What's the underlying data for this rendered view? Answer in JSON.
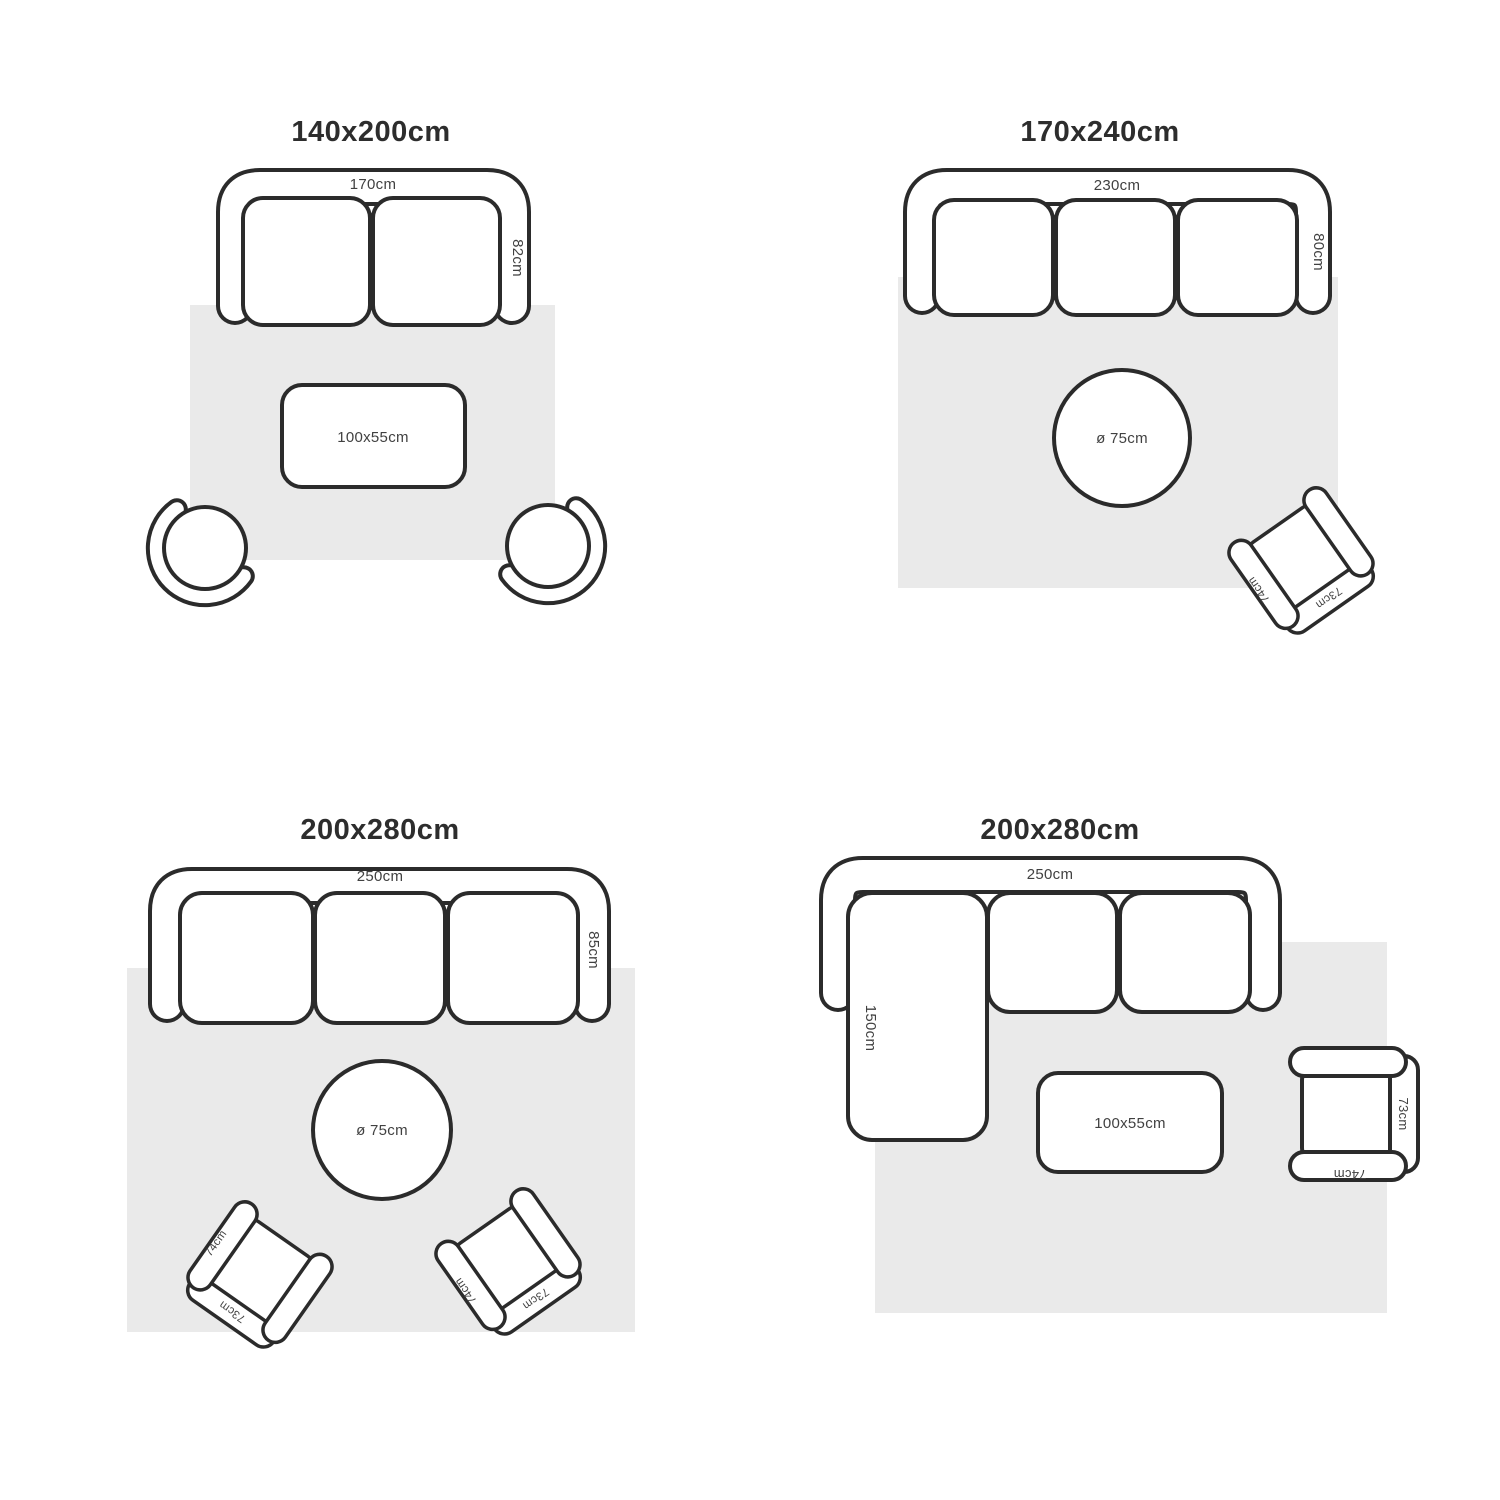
{
  "colors": {
    "line": "#2b2b2b",
    "rug": "#eaeaea",
    "label_text": "#414141",
    "title_text": "#2d2d2d",
    "background": "#ffffff",
    "furniture_fill": "#ffffff"
  },
  "armchair_labels": {
    "back_width": "73cm",
    "side_depth": "74cm"
  },
  "layouts": [
    {
      "title": "140x200cm",
      "sofa_width": "170cm",
      "sofa_depth": "82cm",
      "coffee_table": "100x55cm"
    },
    {
      "title": "170x240cm",
      "sofa_width": "230cm",
      "sofa_depth": "80cm",
      "round_table": "ø 75cm"
    },
    {
      "title": "200x280cm",
      "sofa_width": "250cm",
      "sofa_depth": "85cm",
      "round_table": "ø 75cm"
    },
    {
      "title": "200x280cm",
      "sofa_width": "250cm",
      "chaise_length": "150cm",
      "coffee_table": "100x55cm"
    }
  ]
}
